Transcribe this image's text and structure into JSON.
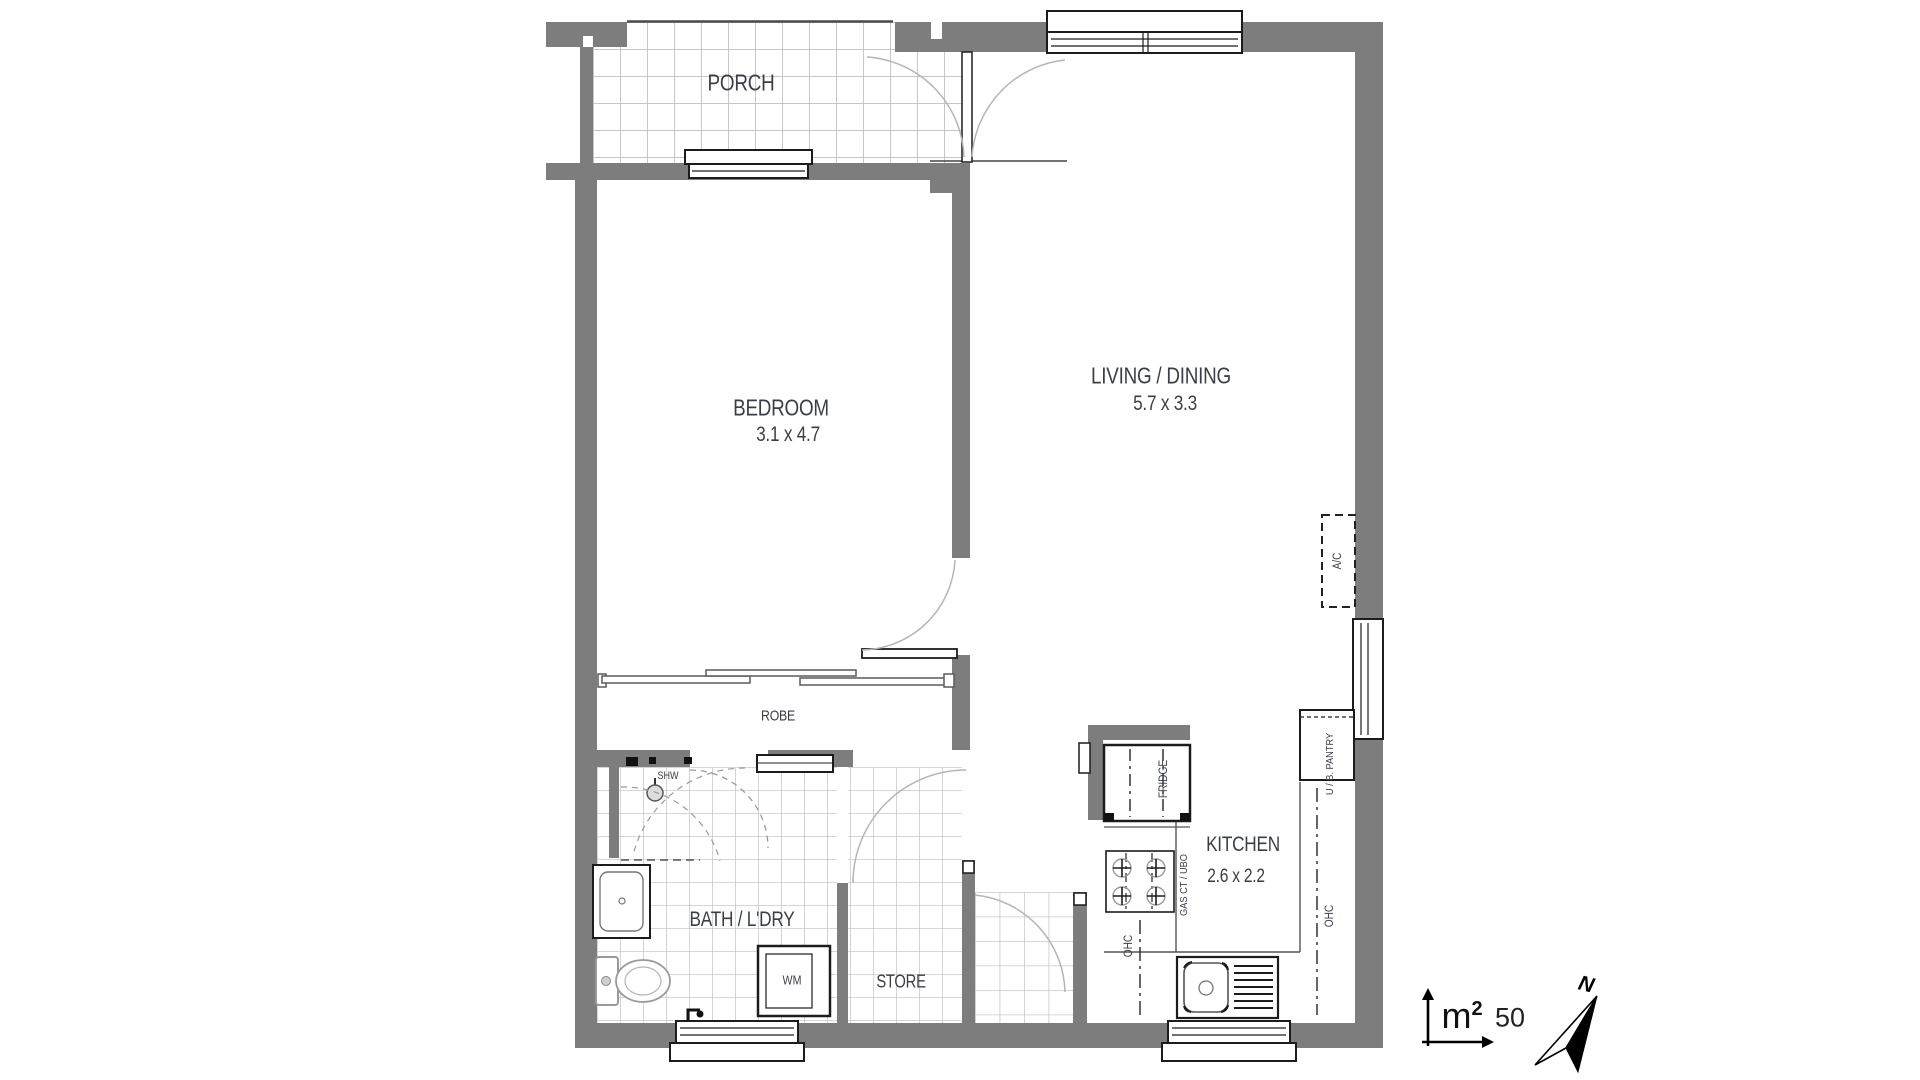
{
  "plan_title": "floor-plan",
  "rooms": {
    "porch": {
      "label": "PORCH"
    },
    "bedroom": {
      "label": "BEDROOM",
      "dims": "3.1 x 4.7"
    },
    "living": {
      "label": "LIVING / DINING",
      "dims": "5.7 x 3.3"
    },
    "robe": {
      "label": "ROBE"
    },
    "bath": {
      "label": "BATH / L'DRY"
    },
    "store": {
      "label": "STORE"
    },
    "kitchen": {
      "label": "KITCHEN",
      "dims": "2.6 x 2.2"
    }
  },
  "fixtures": {
    "shower": "SHW",
    "washing_machine": "WM",
    "fridge": "FRIDGE",
    "cooktop": "GAS CT / UBO",
    "ohc_left": "OHC",
    "ohc_right": "OHC",
    "pantry": "U / B. PANTRY",
    "air_conditioner": "A/C"
  },
  "legend": {
    "area_unit": "m",
    "area_sup": "2",
    "area_value": "50",
    "north_label": "N"
  },
  "colors": {
    "wall": "#7d7d7d",
    "tile_line": "#c6c6c6",
    "label_text": "#3a3e47",
    "door_arc": "#b5b5b5",
    "outline": "#1c1c1c",
    "background": "#ffffff"
  }
}
